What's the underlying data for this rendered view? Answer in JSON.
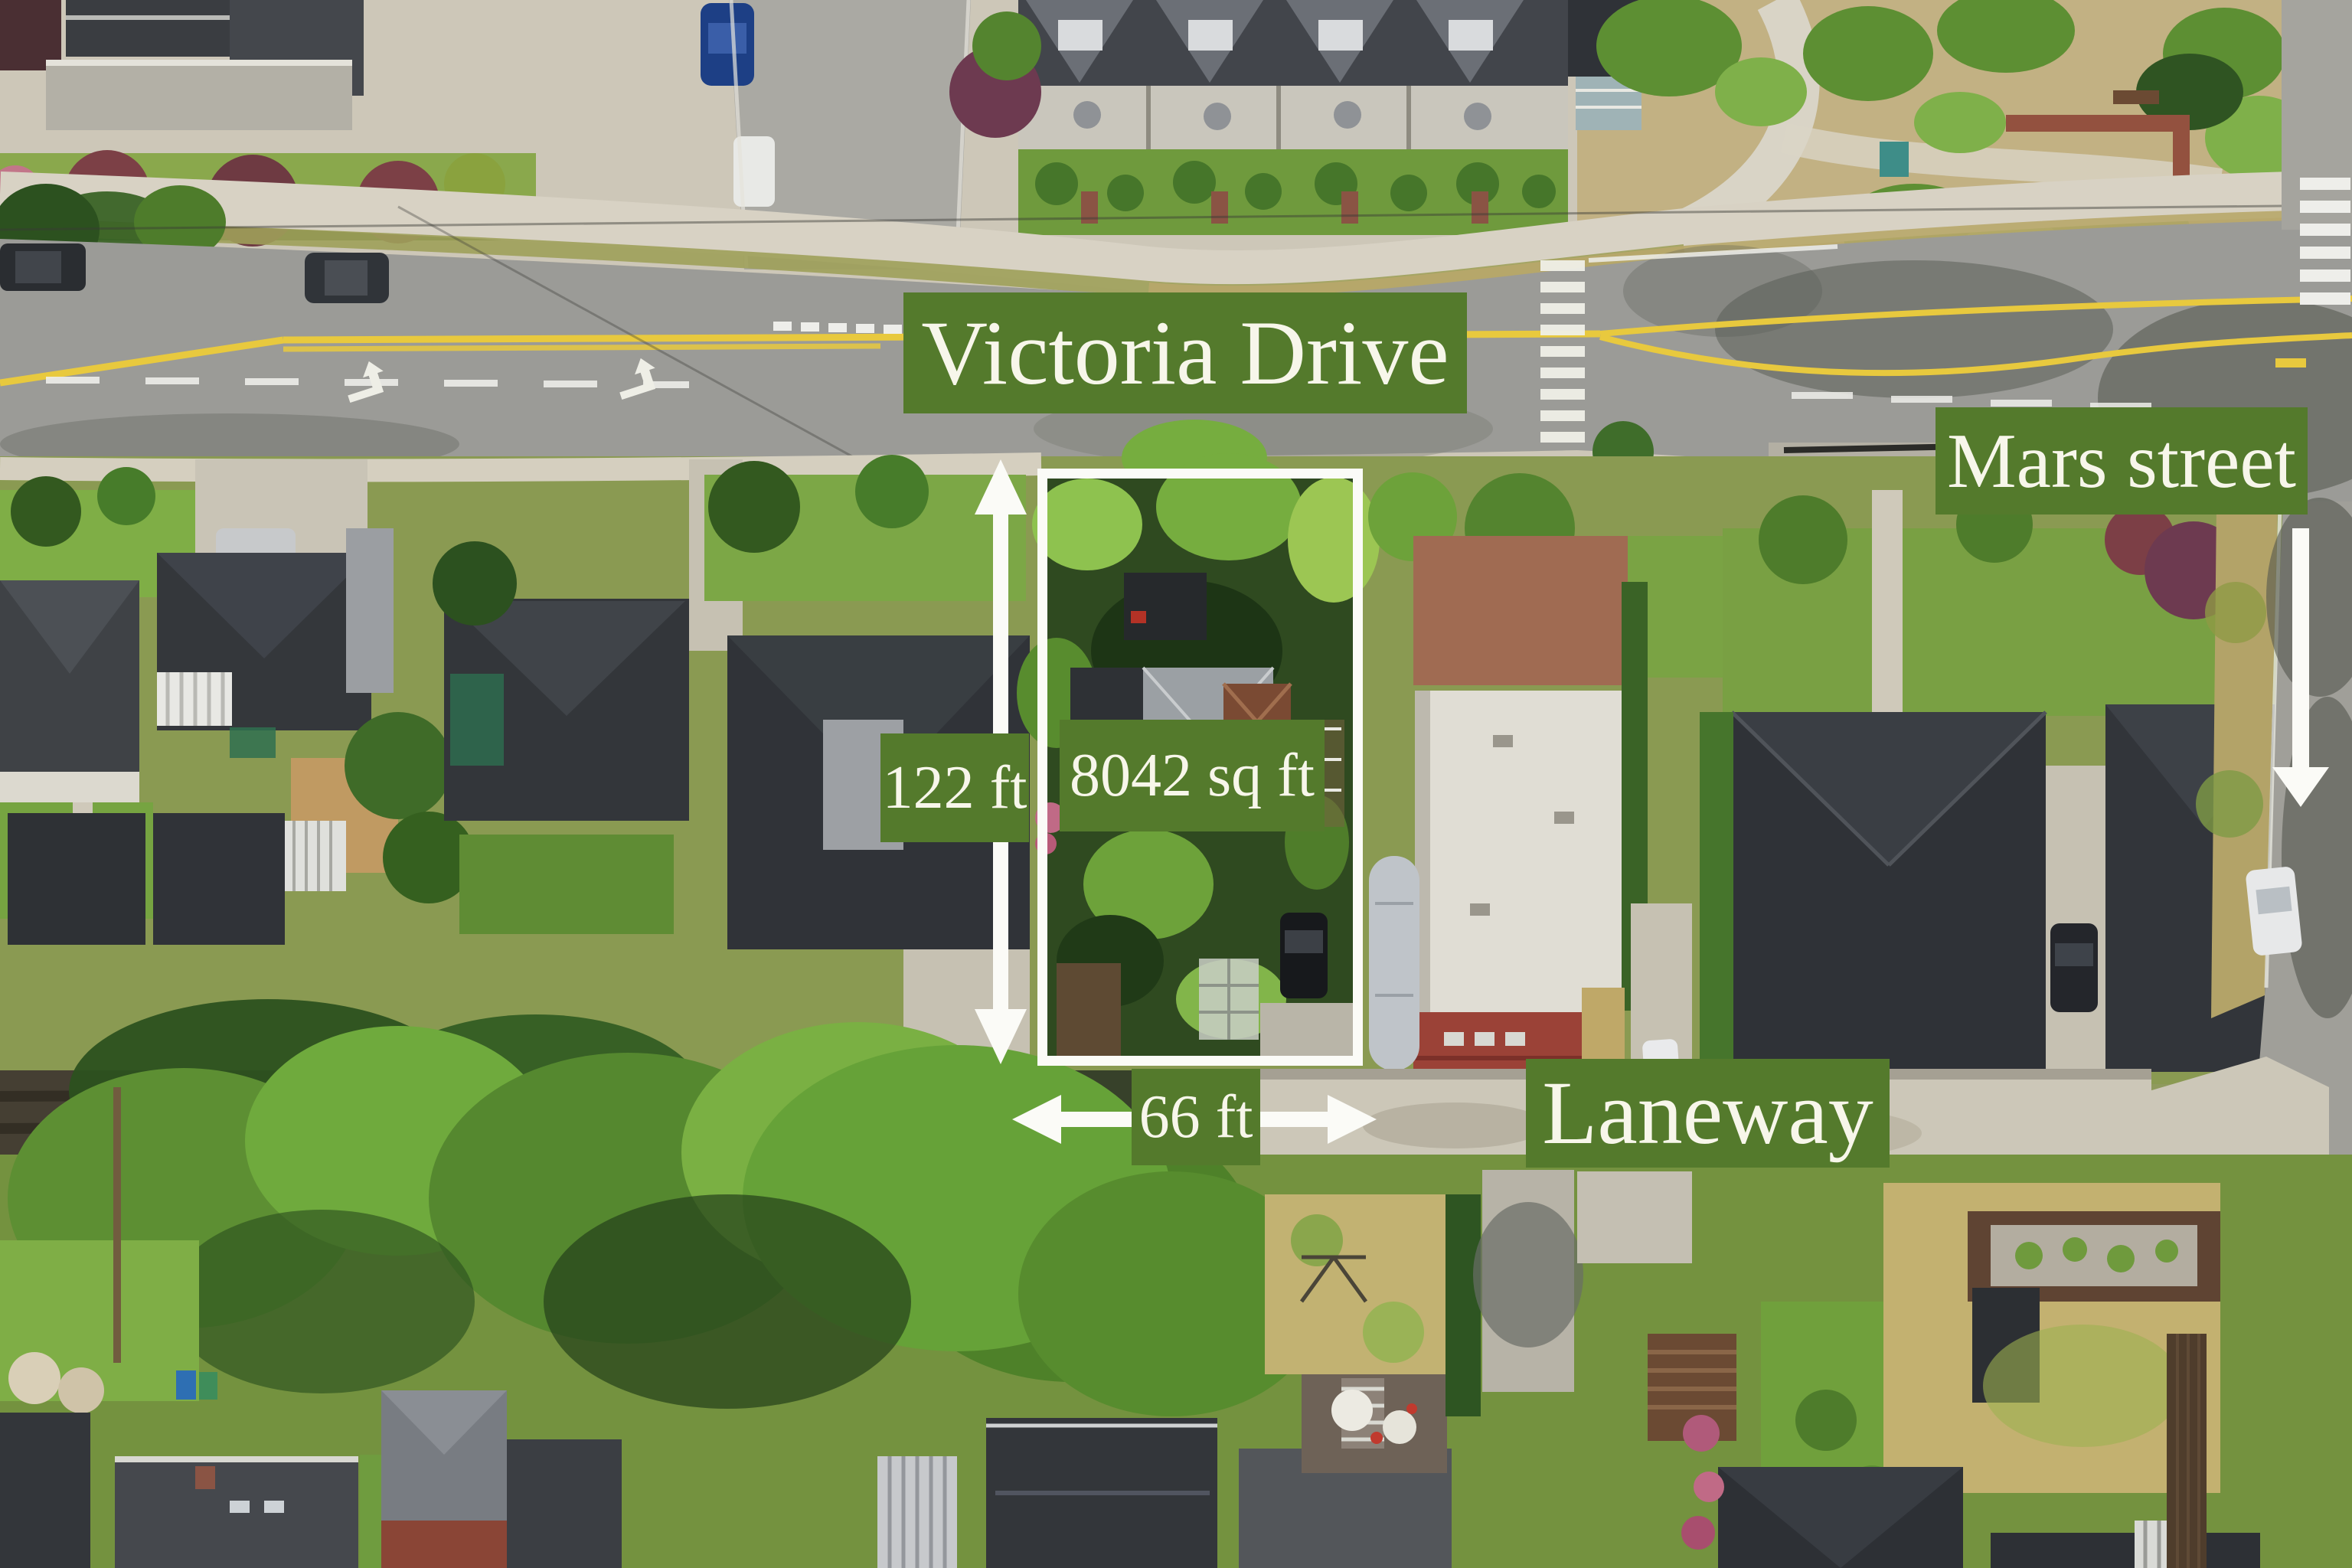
{
  "labels": {
    "victoria_drive": "Victoria Drive",
    "mars_street": "Mars street",
    "lot_depth": "122 ft",
    "lot_area": "8042 sq ft",
    "lot_width": "66 ft",
    "laneway": "Laneway"
  },
  "colors": {
    "label_background": "#547a2c",
    "label_text": "#f7f6ea",
    "annotation_white": "#fbfbf7"
  },
  "icons": {
    "mars_direction": "down-arrow-icon",
    "lot_depth_measure": "vertical-double-arrow-icon",
    "lot_width_measure": "horizontal-double-arrow-icon"
  }
}
